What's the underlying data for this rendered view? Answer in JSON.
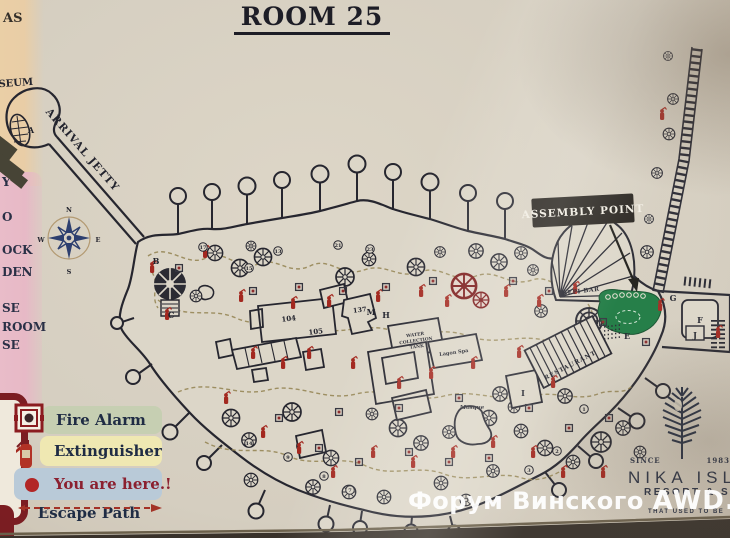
{
  "title": "ROOM 25",
  "left_panel": {
    "top_fragment": "AS",
    "fragments": [
      "Y",
      "O",
      "OCK",
      "DEN",
      "SE",
      "ROOM",
      "SE"
    ]
  },
  "legend": {
    "items": [
      {
        "label": "Fire Alarm"
      },
      {
        "label": "Extinguisher"
      },
      {
        "label": "You are here.!"
      },
      {
        "label": "Escape Path"
      }
    ]
  },
  "compass": {
    "n": "N",
    "s": "S",
    "e": "E",
    "w": "W"
  },
  "map": {
    "arrival_jetty": "ARRIVAL JETTY",
    "museum_fragment": "SEUM",
    "assembly_point": "ASSEMBLY POINT",
    "bepi_bar": "BEPI BAR",
    "restaurant": "RESTAURANT",
    "mosque": "Mosque",
    "water_tank_l1": "WATER",
    "water_tank_l2": "COLLECTION",
    "water_tank_l3": "TANK",
    "lagon_spa": "Lagon Spa",
    "letters": {
      "a": "A",
      "b": "B",
      "c": "C",
      "e": "E",
      "f": "F",
      "g": "G",
      "h": "H",
      "i": "I",
      "j": "J",
      "m": "M"
    },
    "buildings": {
      "b104": "104",
      "b105": "105",
      "b137": "137"
    },
    "hut_numbers": [
      "17",
      "13",
      "15",
      "21",
      "23",
      "14",
      "9",
      "8",
      "7",
      "1",
      "2",
      "3"
    ]
  },
  "logo": {
    "since": "SINCE",
    "year": "1983",
    "name": "NIKA ISLAND",
    "subtitle": "RESORT & SPA",
    "tagline": "THAT USED TO BE"
  },
  "watermark": {
    "text": "Форум Винского",
    "brand": "AWD.RU"
  },
  "colors": {
    "assembly_green": "#1d7a42",
    "marker_red": "#a3281f",
    "legend_green": "#c6cfb2",
    "legend_yellow": "#efe8b2",
    "legend_blue": "#b9cad8",
    "compass_navy": "#2d3f6f",
    "paper": "#d5cec0"
  }
}
